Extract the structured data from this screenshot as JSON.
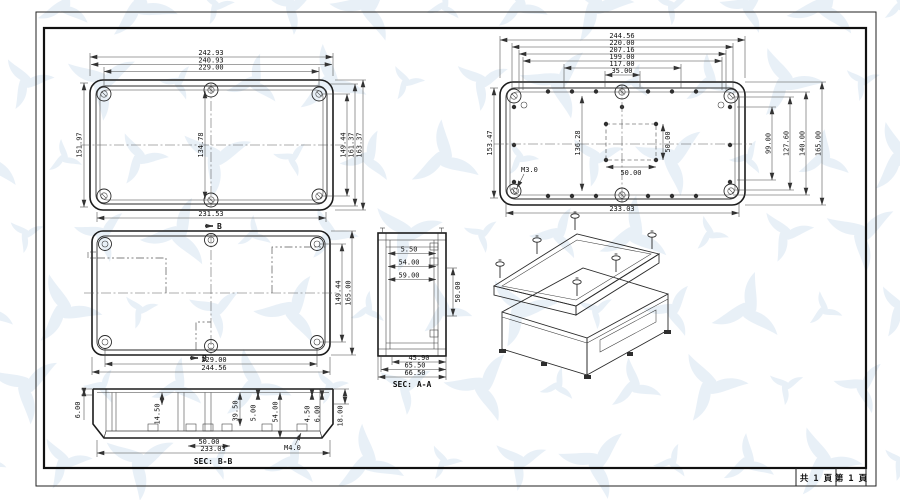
{
  "colors": {
    "watermark": "#d7e4f2",
    "line": "#1c1c1c"
  },
  "sheet": {
    "footer_left": "共 1 頁",
    "footer_right": "第 1 頁"
  },
  "lid_view": {
    "dim_top_1": "242.93",
    "dim_top_2": "240.93",
    "dim_top_3": "229.00",
    "dim_bottom": "231.53",
    "dim_left": "151.97",
    "dim_center": "134.78",
    "dim_right_1": "149.44",
    "dim_right_2": "161.37",
    "dim_right_3": "163.37"
  },
  "base_back_view": {
    "dim_top_1": "244.56",
    "dim_top_2": "220.00",
    "dim_top_3": "207.16",
    "dim_top_4": "199.00",
    "dim_top_5": "117.00",
    "dim_top_6": "35.00",
    "dim_left": "153.47",
    "dim_right_1": "99.00",
    "dim_right_2": "127.60",
    "dim_right_3": "140.00",
    "dim_right_4": "165.00",
    "dim_inner_v": "136.28",
    "dim_square_w": "50.00",
    "dim_square_h": "50.00",
    "dim_bottom": "233.03",
    "thread": "M3.0"
  },
  "base_inside_view": {
    "dim_right_1": "149.44",
    "dim_right_2": "165.00",
    "dim_bottom_1": "229.00",
    "dim_bottom_2": "244.56",
    "marker_top": "B",
    "marker_bottom": "B"
  },
  "section_aa": {
    "label": "SEC: A-A",
    "dim_depth_1": "5.50",
    "dim_depth_2": "54.00",
    "dim_depth_3": "59.00",
    "dim_right": "50.00",
    "dim_bottom_1": "45.90",
    "dim_bottom_2": "65.50",
    "dim_bottom_3": "66.50"
  },
  "section_bb": {
    "label": "SEC: B-B",
    "dim_left": "6.00",
    "dim_v_1": "14.50",
    "dim_v_2": "39.50",
    "dim_v_3": "5.00",
    "dim_v_4": "54.00",
    "dim_v_5": "4.50",
    "dim_v_6": "6.00",
    "dim_right": "18.00",
    "dim_bottom_1": "50.00",
    "dim_bottom_2": "233.03",
    "thread": "M4.0"
  }
}
